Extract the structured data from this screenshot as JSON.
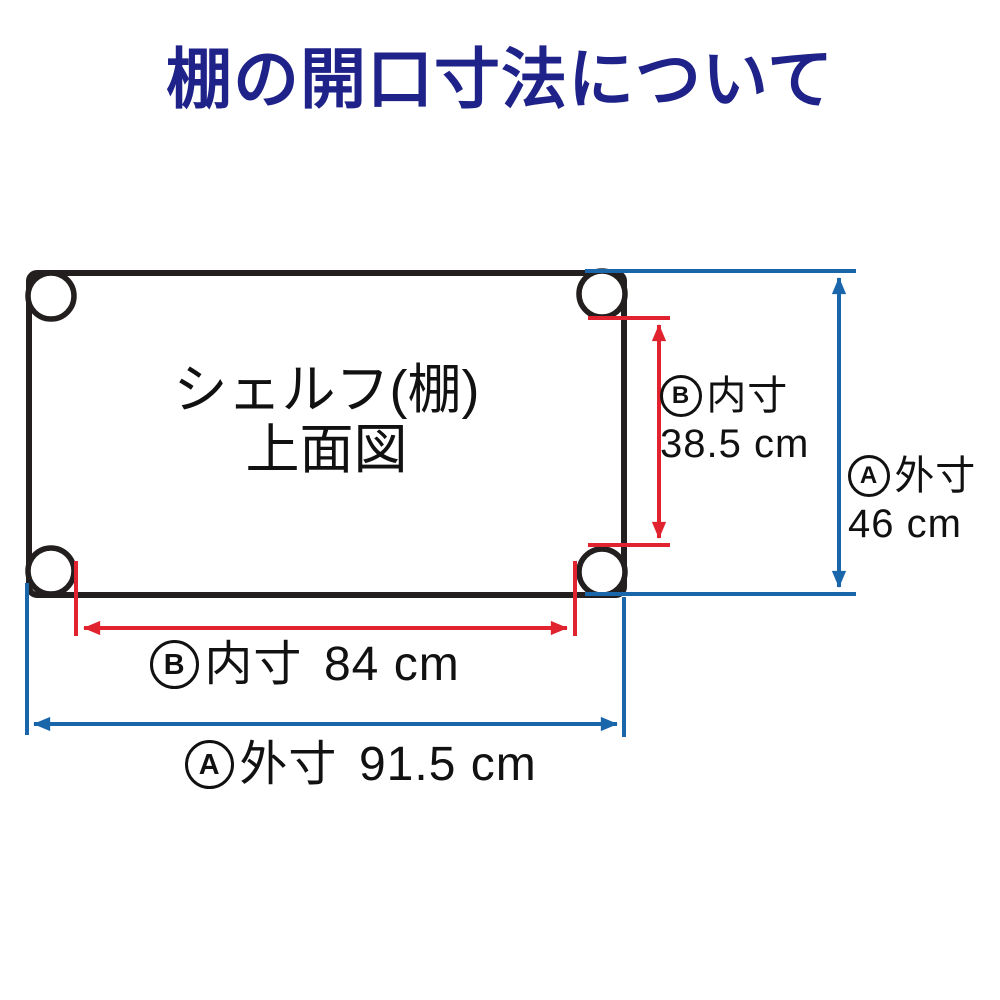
{
  "title": {
    "text": "棚の開口寸法について",
    "color": "#1f2288"
  },
  "diagram": {
    "shelf_label_line1": "シェルフ(棚)",
    "shelf_label_line2": "上面図",
    "dimensions": {
      "inner_depth": {
        "marker": "B",
        "label": "内寸",
        "value": "38.5 cm"
      },
      "outer_depth": {
        "marker": "A",
        "label": "外寸",
        "value": "46 cm"
      },
      "inner_width": {
        "marker": "B",
        "label": "内寸",
        "value": "84 cm"
      },
      "outer_width": {
        "marker": "A",
        "label": "外寸",
        "value": "91.5 cm"
      }
    },
    "colors": {
      "outline_black": "#231f1f",
      "inner_dimension_red": "#e0232e",
      "outer_dimension_blue": "#1a66ab",
      "title_navy": "#1f2288",
      "background": "#ffffff"
    }
  }
}
